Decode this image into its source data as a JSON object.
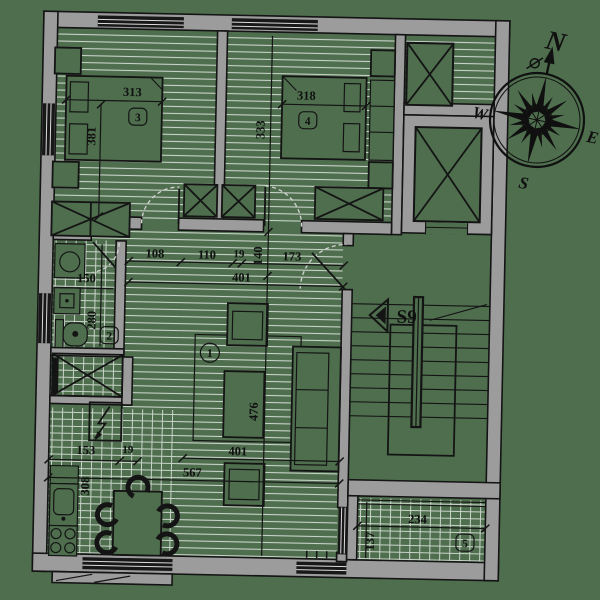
{
  "title": "Apartment floor plan",
  "compass": {
    "n": "N",
    "e": "E",
    "s": "S",
    "w": "W"
  },
  "rooms": {
    "living": {
      "tag": "1"
    },
    "bath": {
      "tag": "2"
    },
    "bedroom_a": {
      "tag": "3"
    },
    "bedroom_b": {
      "tag": "4"
    },
    "balcony": {
      "tag": "5"
    },
    "stairs": {
      "label": "S9"
    }
  },
  "dims": {
    "bed3_w": "313",
    "bed3_d": "381",
    "bed4_w": "318",
    "bed4_d": "333",
    "hall_a": "108",
    "hall_b": "110",
    "hall_c": "19",
    "hall_d": "173",
    "hall_total": "401",
    "hall_e": "140",
    "bath_w": "150",
    "bath_d": "280",
    "kit_a": "153",
    "kit_b": "19",
    "kit_d": "308",
    "kit_total": "567",
    "liv_w": "401",
    "liv_d": "476",
    "balc_w": "234",
    "balc_d": "137"
  },
  "colors": {
    "background": "#4e6e4e",
    "wall": "#9c9c9c",
    "line": "#141414",
    "hatch": "#c9d3c9",
    "window_band": "#181818"
  }
}
